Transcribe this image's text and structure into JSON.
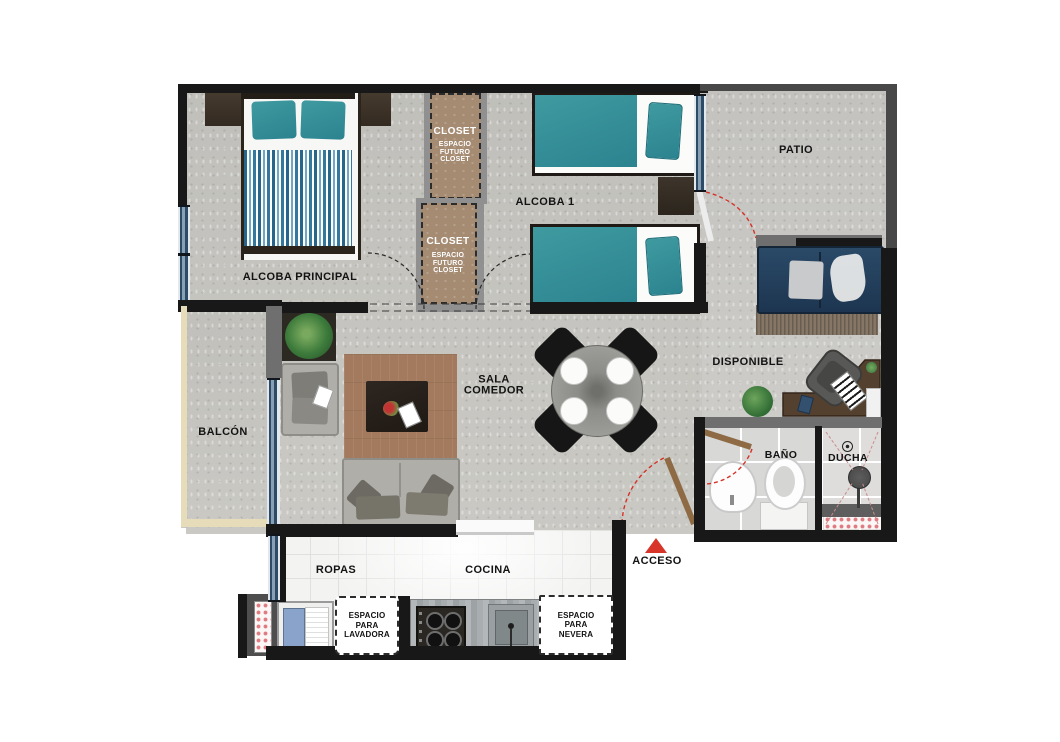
{
  "rooms": {
    "alcoba_principal": {
      "label": "ALCOBA PRINCIPAL"
    },
    "alcoba_1": {
      "label": "ALCOBA 1"
    },
    "patio": {
      "label": "PATIO"
    },
    "disponible": {
      "label": "DISPONIBLE"
    },
    "sala_comedor": {
      "label": "SALA COMEDOR"
    },
    "balcon": {
      "label": "BALCÓN"
    },
    "bano": {
      "label": "BAÑO"
    },
    "ducha": {
      "label": "DUCHA"
    },
    "ropas": {
      "label": "ROPAS"
    },
    "cocina": {
      "label": "COCINA"
    }
  },
  "closets": [
    {
      "title": "CLOSET",
      "subtitle": "ESPACIO FUTURO CLOSET"
    },
    {
      "title": "CLOSET",
      "subtitle": "ESPACIO FUTURO CLOSET"
    }
  ],
  "appliance_spaces": {
    "lavadora": {
      "label": "ESPACIO PARA LAVADORA"
    },
    "nevera": {
      "label": "ESPACIO PARA NEVERA"
    }
  },
  "entrance": {
    "label": "ACCESO"
  },
  "colors": {
    "wall": "#181818",
    "floor_concrete": "#c8c7c2",
    "closet_fill": "#a58b72",
    "bed_teal": "#2e8a96",
    "sofa_navy": "#22405c",
    "rug_brown": "#a37a5e",
    "accent_red": "#d8352a",
    "balcony_trim": "#e6dcba",
    "window_glass": "#2d4a66"
  }
}
